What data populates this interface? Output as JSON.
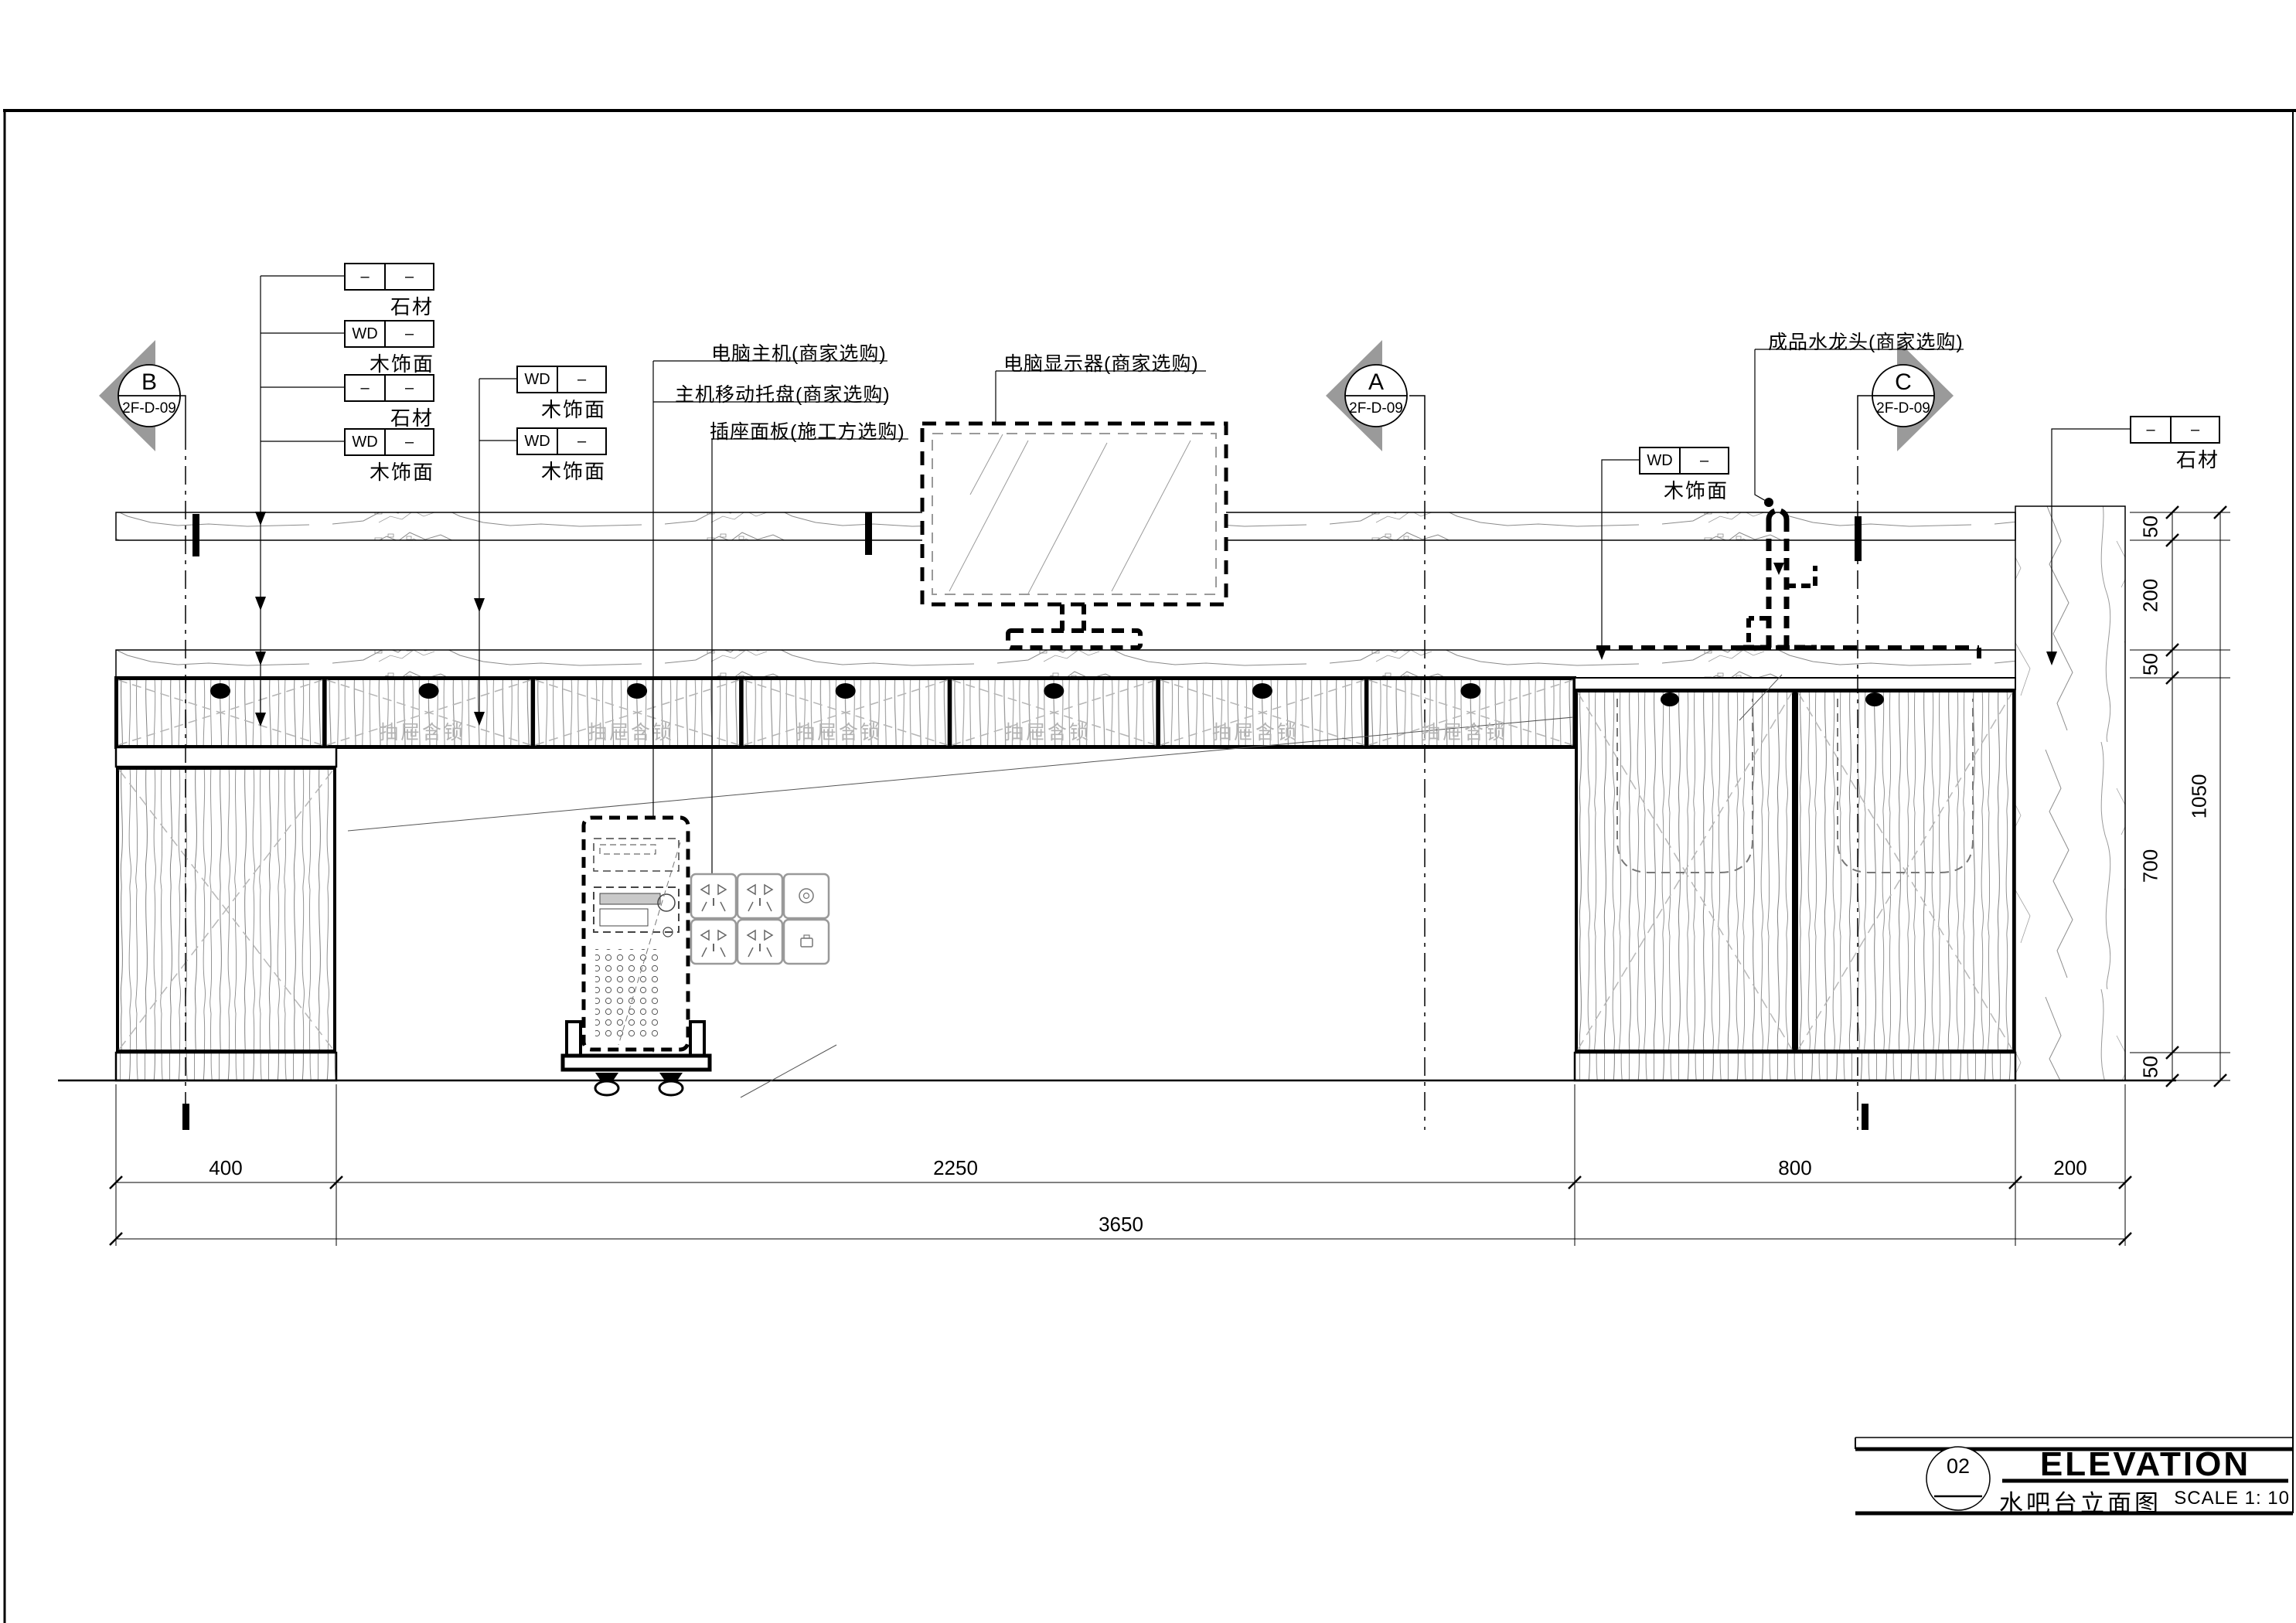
{
  "titleblock": {
    "number": "02",
    "title_en": "ELEVATION",
    "title_cn": "水吧台立面图",
    "scale": "SCALE 1: 10"
  },
  "markers": [
    {
      "letter": "B",
      "code": "2F-D-09"
    },
    {
      "letter": "A",
      "code": "2F-D-09"
    },
    {
      "letter": "C",
      "code": "2F-D-09"
    }
  ],
  "tags": {
    "left": [
      {
        "c1": "–",
        "c2": "–",
        "label": "石材"
      },
      {
        "c1": "WD",
        "c2": "–",
        "label": "木饰面"
      },
      {
        "c1": "–",
        "c2": "–",
        "label": "石材"
      },
      {
        "c1": "WD",
        "c2": "–",
        "label": "木饰面"
      }
    ],
    "mid": [
      {
        "c1": "WD",
        "c2": "–",
        "label": "木饰面"
      },
      {
        "c1": "WD",
        "c2": "–",
        "label": "木饰面"
      }
    ],
    "faucet_area": {
      "c1": "WD",
      "c2": "–",
      "label": "木饰面"
    },
    "top_right": {
      "c1": "–",
      "c2": "–",
      "label": "石材"
    }
  },
  "callouts": {
    "computer_host": "电脑主机(商家选购)",
    "host_tray": "主机移动托盘(商家选购)",
    "socket_panel": "插座面板(施工方选购)",
    "monitor": "电脑显示器(商家选购)",
    "faucet": "成品水龙头(商家选购)"
  },
  "drawers": {
    "label": "抽屉含锁"
  },
  "dims": {
    "bottom": {
      "s0": "400",
      "s1": "2250",
      "s2": "800",
      "s3": "200",
      "overall": "3650"
    },
    "right": {
      "s0": "50",
      "s1": "200",
      "s2": "50",
      "s3": "700",
      "s4": "50",
      "overall": "1050"
    }
  }
}
